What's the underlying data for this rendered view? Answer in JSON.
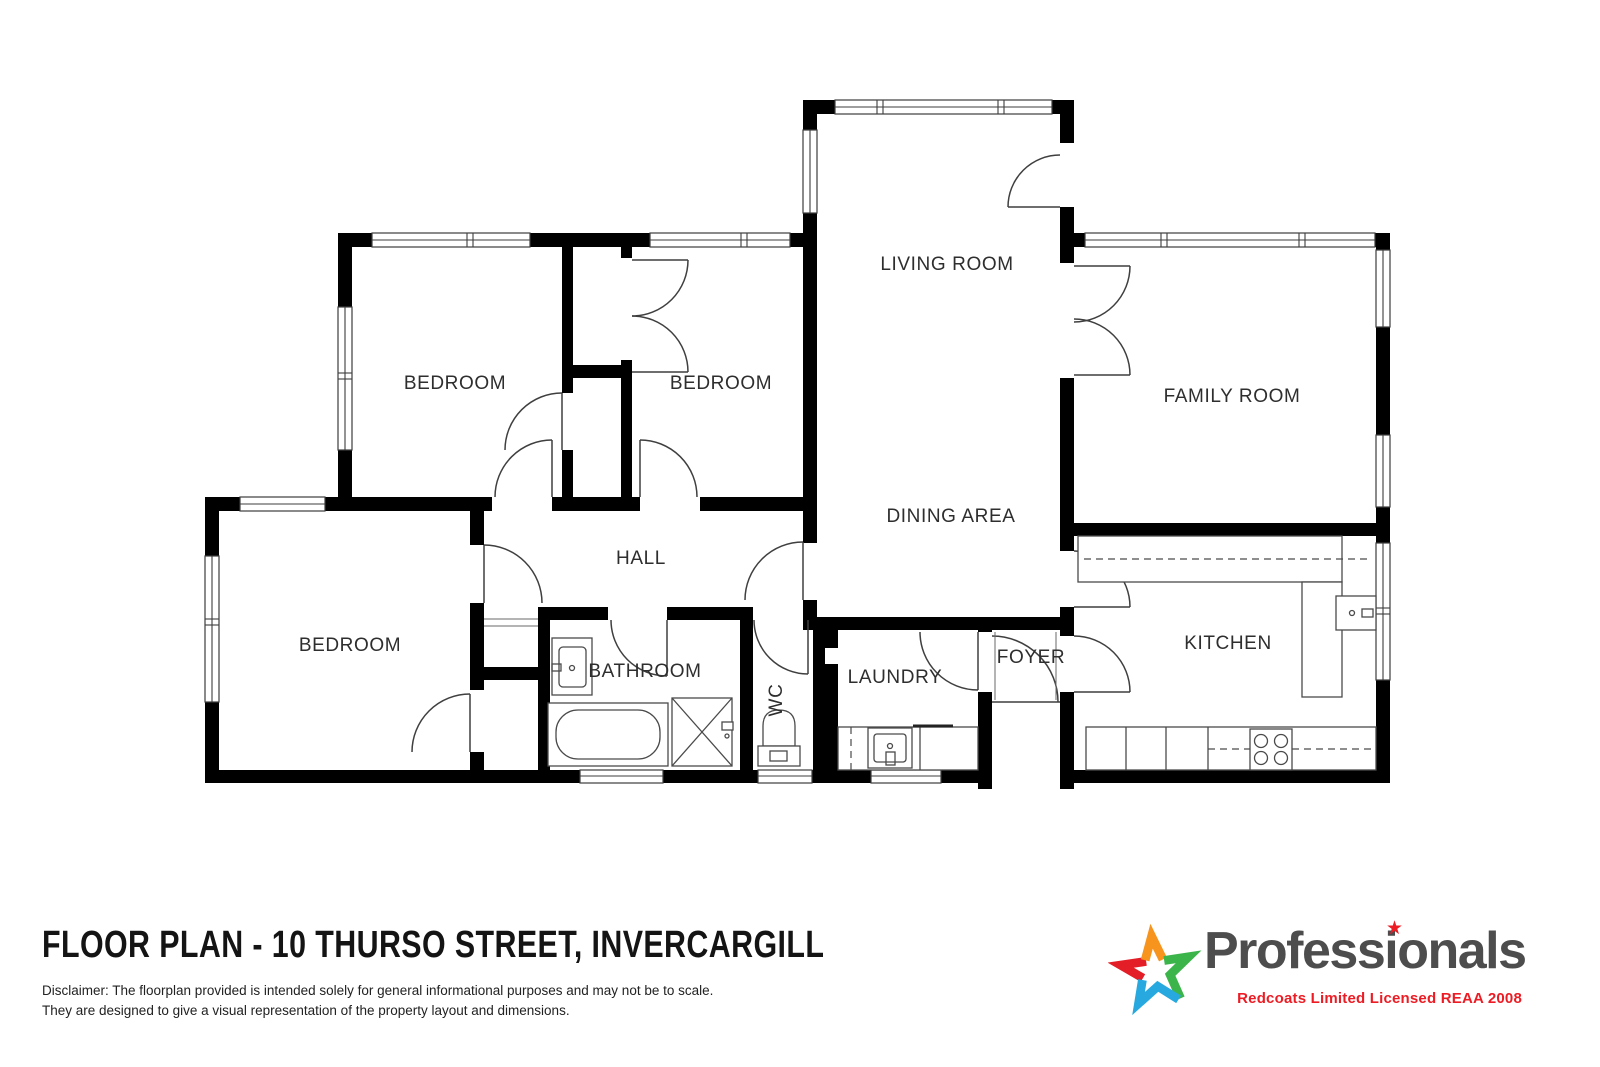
{
  "floorplan": {
    "rooms": [
      {
        "name": "living-room",
        "label": "LIVING ROOM"
      },
      {
        "name": "dining-area",
        "label": "DINING AREA"
      },
      {
        "name": "family-room",
        "label": "FAMILY ROOM"
      },
      {
        "name": "kitchen",
        "label": "KITCHEN"
      },
      {
        "name": "bedroom-top-left",
        "label": "BEDROOM"
      },
      {
        "name": "bedroom-top-middle",
        "label": "BEDROOM"
      },
      {
        "name": "bedroom-bottom-left",
        "label": "BEDROOM"
      },
      {
        "name": "hall",
        "label": "HALL"
      },
      {
        "name": "bathroom",
        "label": "BATHROOM"
      },
      {
        "name": "wc",
        "label": "WC"
      },
      {
        "name": "laundry",
        "label": "LAUNDRY"
      },
      {
        "name": "foyer",
        "label": "FOYER"
      }
    ]
  },
  "footer": {
    "title": "FLOOR PLAN - 10 THURSO STREET, INVERCARGILL",
    "disclaimer_line1": "Disclaimer: The floorplan provided is intended solely for general informational purposes and may not be to scale.",
    "disclaimer_line2": "They are designed to give a visual representation of the property layout and dimensions."
  },
  "branding": {
    "wordmark": "Professionals",
    "tagline": "Redcoats Limited Licensed REAA 2008",
    "star_dot_glyph": "★",
    "colors": {
      "wordmark": "#4d4d4d",
      "tagline": "#ed1c24",
      "star_red": "#e31e26",
      "star_orange": "#f7941d",
      "star_green": "#3bb54a",
      "star_blue": "#27a9e0",
      "walls": "#000000"
    }
  }
}
